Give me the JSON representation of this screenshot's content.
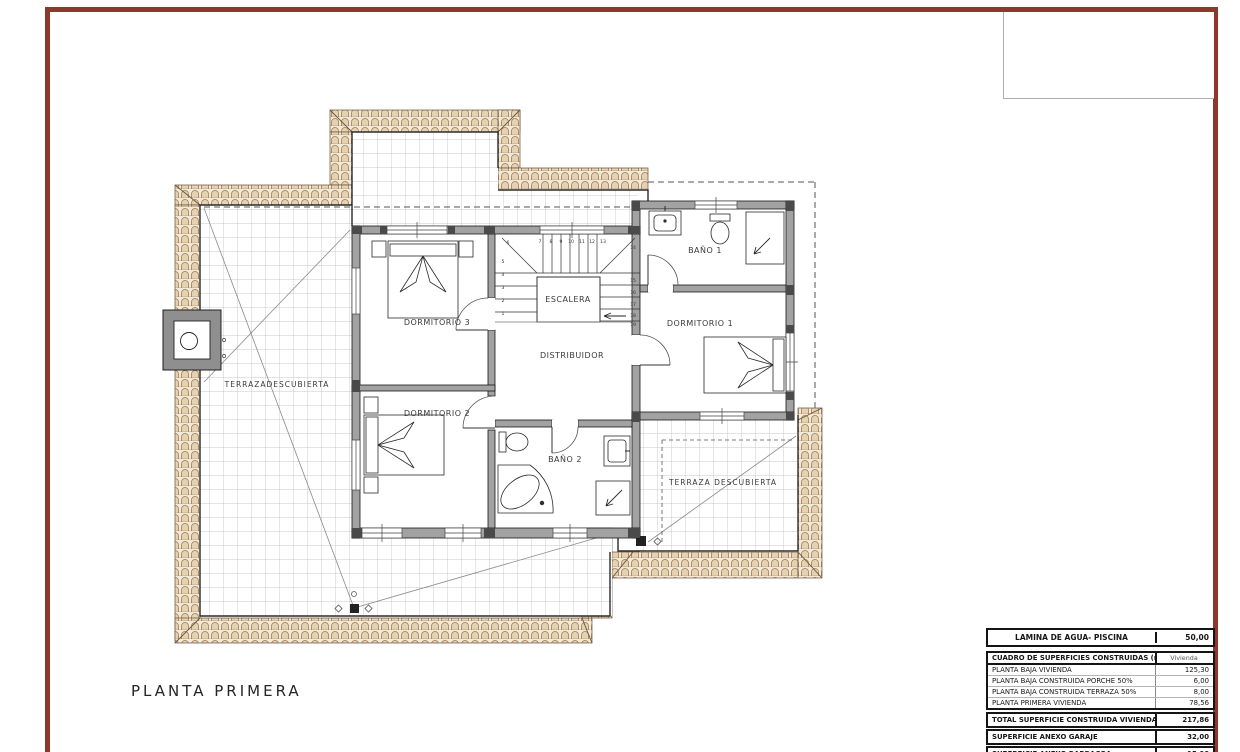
{
  "sheet": {
    "title": "PLANTA PRIMERA"
  },
  "colors": {
    "frame_red": "#8d382c",
    "tile_fill": "#f2e9d8",
    "tile_stroke": "#9f7a52",
    "wall_gray": "#a2a2a2",
    "wall_dark": "#4a4a4a",
    "grid_line": "#b8b8b8",
    "line_dark": "#1a1a1a"
  },
  "plan": {
    "rooms": {
      "dormitorio3": "DORMITORIO 3",
      "dormitorio2": "DORMITORIO 2",
      "dormitorio1": "DORMITORIO 1",
      "bano1": "BAÑO 1",
      "bano2": "BAÑO 2",
      "distribuidor": "DISTRIBUIDOR",
      "terraza_izquierda": "TERRAZADESCUBIERTA",
      "terraza_derecha": "TERRAZA DESCUBIERTA"
    },
    "stairs": {
      "label": "ESCALERA",
      "steps": [
        "1",
        "2",
        "3",
        "4",
        "5",
        "6",
        "7",
        "8",
        "9",
        "10",
        "11",
        "12",
        "13",
        "14",
        "15",
        "16",
        "17",
        "18",
        "19"
      ]
    }
  },
  "tables": {
    "lamina": {
      "label": "LAMINA DE AGUA- PISCINA",
      "value": "50,00"
    },
    "cuadro": {
      "header": {
        "label": "CUADRO DE SUPERFICIES CONSTRUIDAS (m2)",
        "value": "Vivienda"
      },
      "rows": [
        {
          "label": "PLANTA BAJA VIVIENDA",
          "value": "125,30"
        },
        {
          "label": "PLANTA BAJA CONSTRUIDA PORCHE 50%",
          "value": "6,00"
        },
        {
          "label": "PLANTA BAJA CONSTRUIDA TERRAZA 50%",
          "value": "8,00"
        },
        {
          "label": "PLANTA PRIMERA VIVIENDA",
          "value": "78,56"
        }
      ]
    },
    "totals": [
      {
        "label": "TOTAL SUPERFICIE CONSTRUIDA VIVIENDA",
        "value": "217,86"
      },
      {
        "label": "SUPERFICIE ANEXO GARAJE",
        "value": "32,00"
      },
      {
        "label": "SUPERFICIE ANEXO BARBACOA",
        "value": "15,00"
      },
      {
        "label": "TOTAL SUPERFICIE CONSTRUIDA VIVIENDA + ANEXOS",
        "value": "264,86"
      }
    ]
  }
}
